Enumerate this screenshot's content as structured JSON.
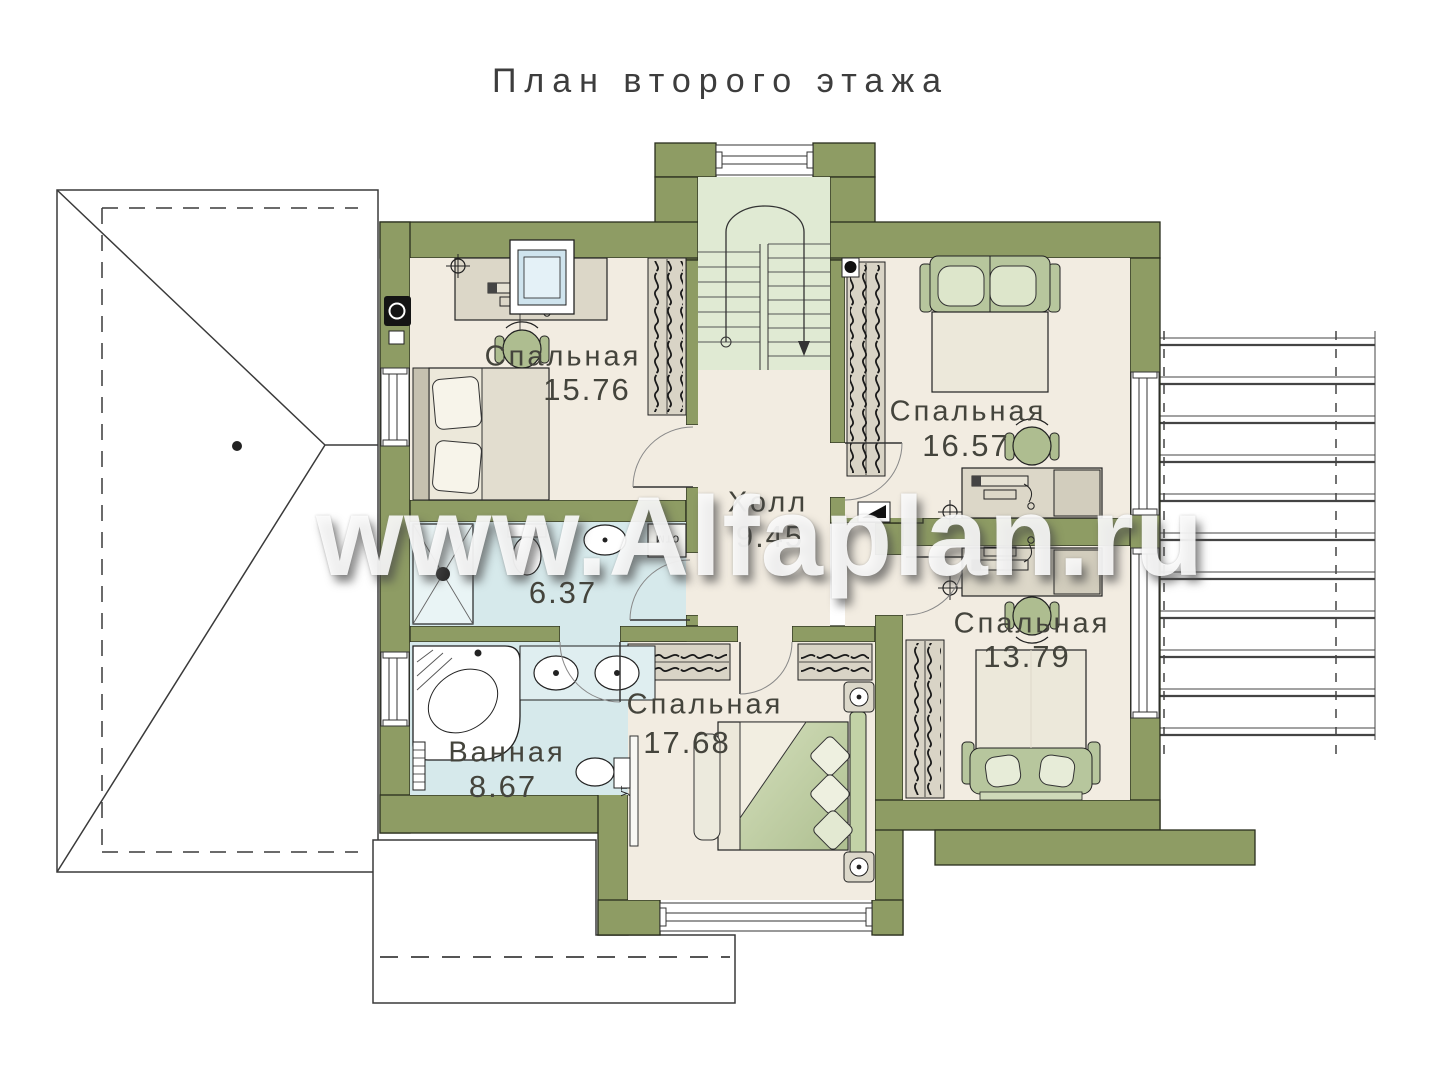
{
  "page": {
    "title": "План второго этажа",
    "watermark": "www.Alfaplan.ru"
  },
  "colors": {
    "wall": "#8e9c64",
    "floor": "#f2ece1",
    "wet_floor": "#d6e9eb",
    "stair_floor": "#e0ead3",
    "furniture_green": "#b7c69d",
    "outline": "#2a2e1d"
  },
  "rooms": [
    {
      "id": "bedroom-1",
      "name": "Спальная",
      "area": "15.76"
    },
    {
      "id": "bedroom-2",
      "name": "Спальная",
      "area": "16.57"
    },
    {
      "id": "hall",
      "name": "Холл",
      "area": "9.45"
    },
    {
      "id": "shower-room",
      "name": "",
      "area": "6.37"
    },
    {
      "id": "bathroom",
      "name": "Ванная",
      "area": "8.67"
    },
    {
      "id": "bedroom-3",
      "name": "Спальная",
      "area": "17.68"
    },
    {
      "id": "bedroom-4",
      "name": "Спальная",
      "area": "13.79"
    }
  ],
  "labels": {
    "washing_machine": "стм",
    "tv": "ут"
  }
}
